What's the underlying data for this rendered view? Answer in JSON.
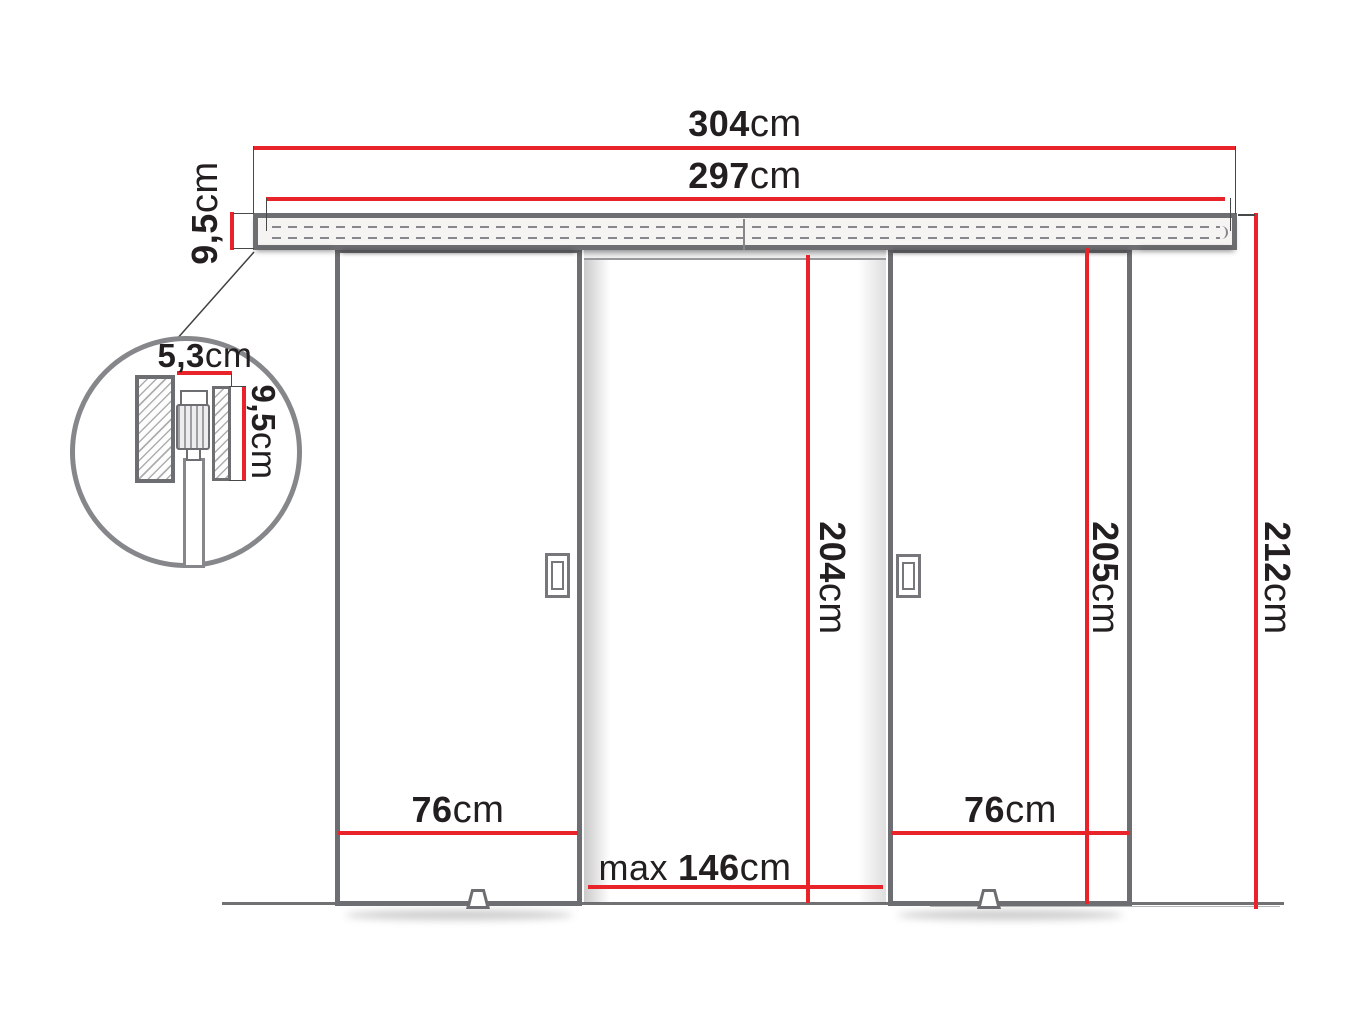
{
  "diagram": {
    "dimensions": {
      "total_width": {
        "value": "304",
        "unit": "cm"
      },
      "track_length": {
        "value": "297",
        "unit": "cm"
      },
      "rail_height": {
        "value": "9,5",
        "unit": "cm"
      },
      "detail_depth": {
        "value": "5,3",
        "unit": "cm"
      },
      "detail_height": {
        "value": "9,5",
        "unit": "cm"
      },
      "left_door_width": {
        "value": "76",
        "unit": "cm"
      },
      "right_door_width": {
        "value": "76",
        "unit": "cm"
      },
      "max_opening_width": {
        "prefix": "max",
        "value": "146",
        "unit": "cm"
      },
      "opening_height": {
        "value": "204",
        "unit": "cm"
      },
      "door_height": {
        "value": "205",
        "unit": "cm"
      },
      "total_height": {
        "value": "212",
        "unit": "cm"
      }
    },
    "colors": {
      "dimension_red": "#e8232a",
      "outline_gray": "#6d6e71",
      "text_dark": "#231f20"
    }
  }
}
